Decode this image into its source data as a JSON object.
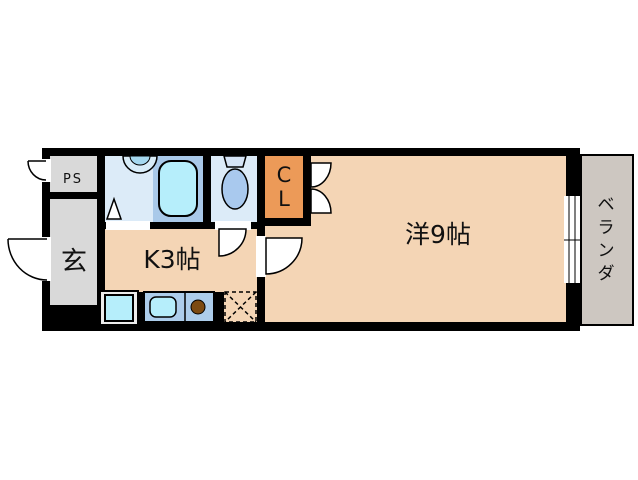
{
  "floorplan": {
    "title": "apartment-floorplan",
    "rooms": {
      "ps": {
        "label": "PS"
      },
      "entrance": {
        "label": "玄"
      },
      "kitchen": {
        "label": "K3帖"
      },
      "closet": {
        "line1": "C",
        "line2": "L"
      },
      "western_room": {
        "label": "洋9帖"
      },
      "veranda": {
        "label": "ベランダ",
        "chars": [
          "ベ",
          "ラ",
          "ン",
          "ダ"
        ]
      }
    },
    "colors": {
      "wall_black": "#000000",
      "room_peach": "#f4d5b5",
      "room_gray": "#d9d9d9",
      "bath_blue": "#dcebf8",
      "tub_surround": "#a9c9e9",
      "fixture_cyan": "#b6eefb",
      "toilet_blue": "#a9c9ee",
      "tank_blue": "#d5e4f6",
      "counter_blue": "#adcdeb",
      "closet_orange": "#ec9a58",
      "veranda_gray": "#cdc7c1",
      "burner_brown": "#7c4a12",
      "pan_gray": "#ececec",
      "door_white": "#ffffff"
    }
  }
}
